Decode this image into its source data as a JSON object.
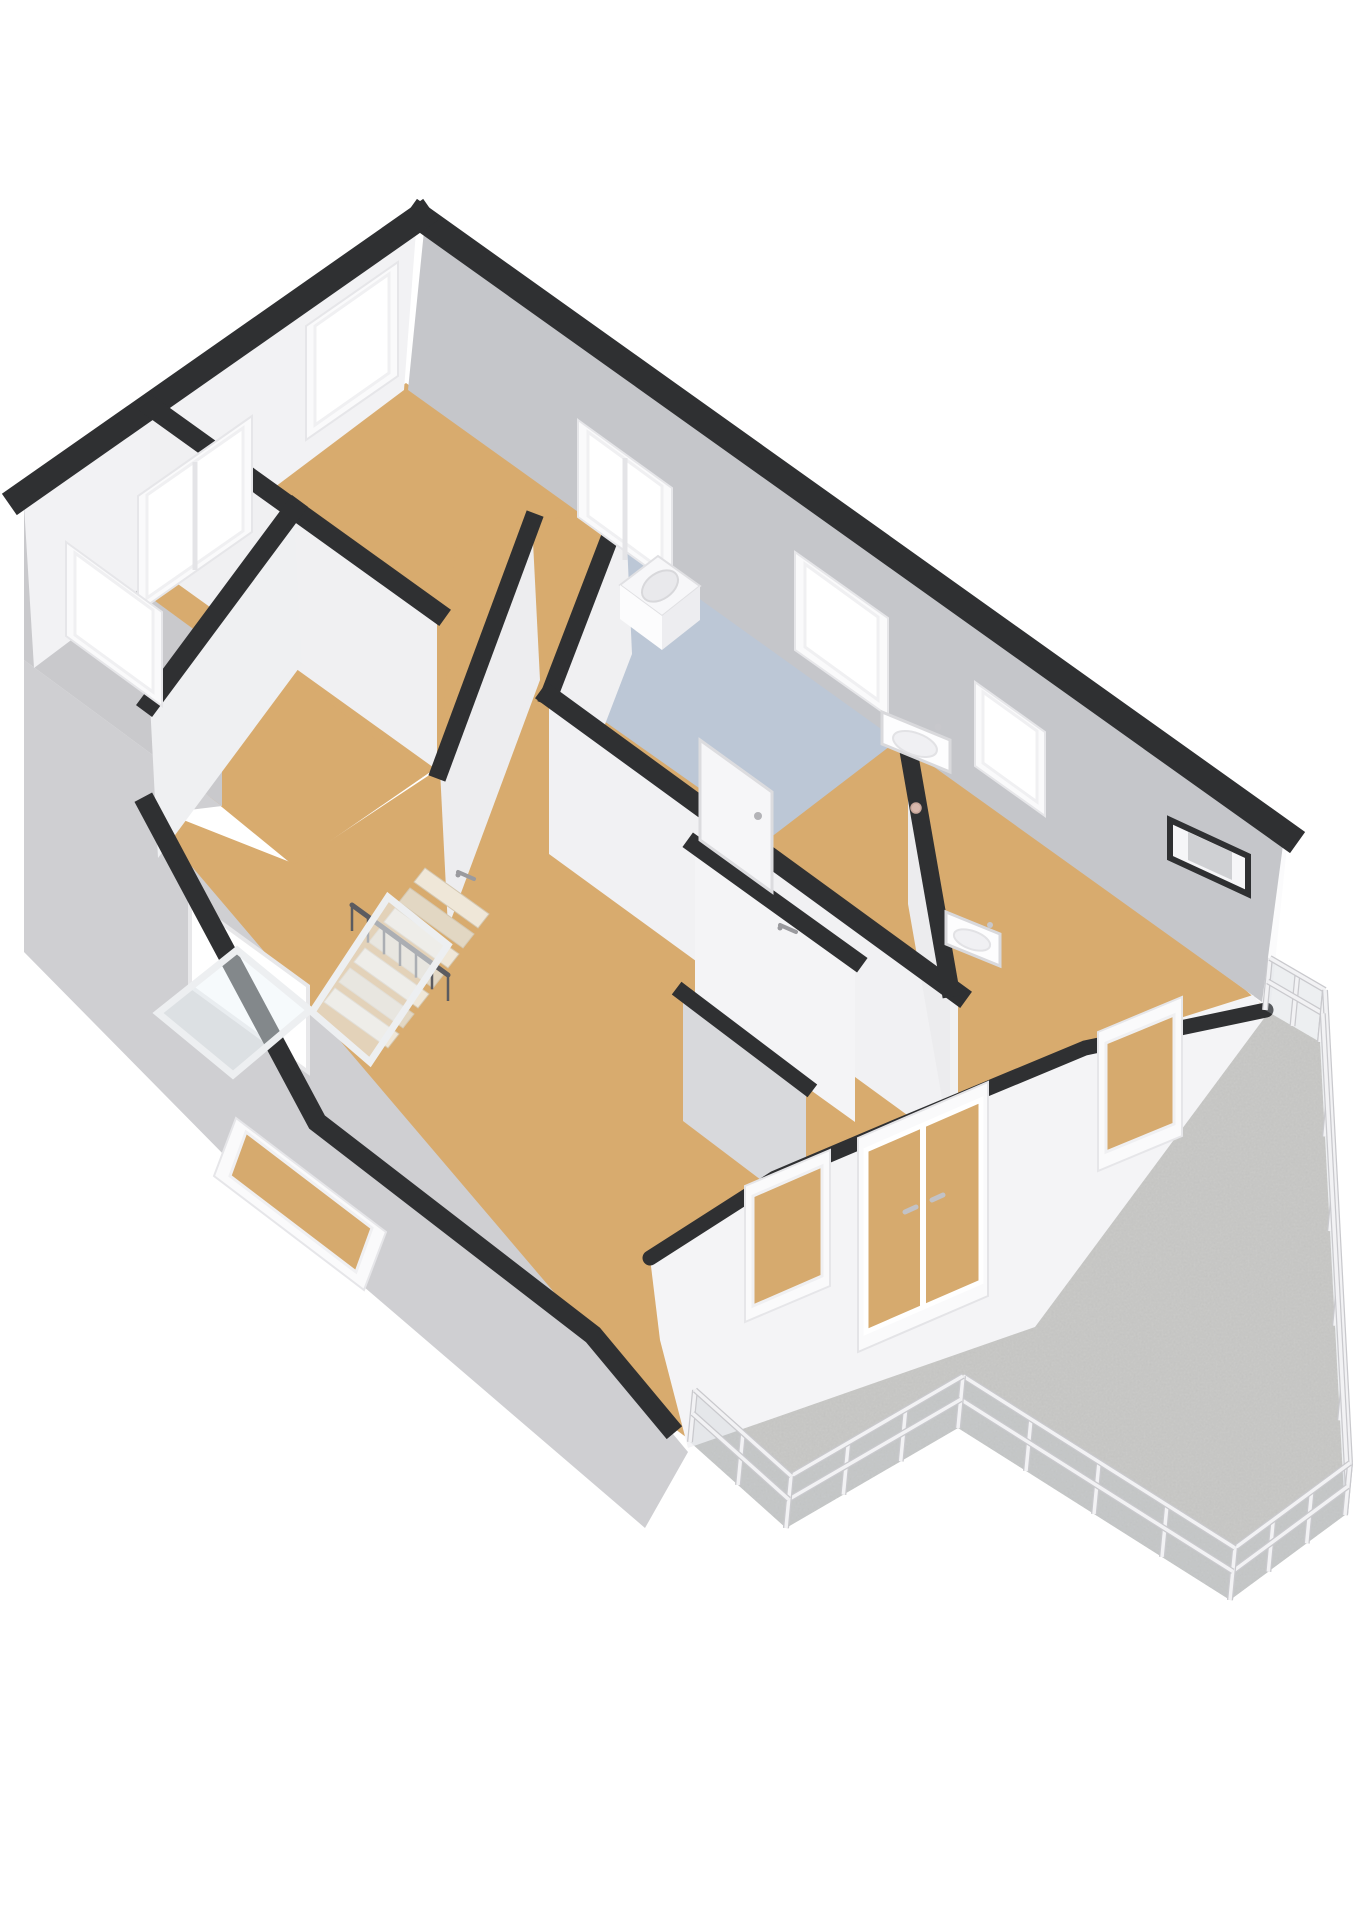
{
  "scene": {
    "type": "3d-floorplan-render",
    "view": "axonometric-top-down",
    "floor_label": "upper-floor",
    "background": "#ffffff"
  },
  "colors": {
    "band": "#2f3032",
    "wall_white": "#f2f2f4",
    "wall_gray": "#c5c6ca",
    "gable_gray": "#c9c9cc",
    "slope_gray": "#cfcfd2",
    "floor_tan": "#d8ab6e",
    "floor_blue": "#bcc7d6",
    "terrace_concrete": "#c9c9c7",
    "frame_white": "#fafafb",
    "glass_white": "#ffffff",
    "glass_tan": "#d6aa6e",
    "railing_light": "#f2f2f4",
    "railing_shadow": "#c9c9cd",
    "stair_wood_a": "#efe7d8",
    "stair_wood_b": "#e2d7c3",
    "handrail_dark": "#5b5b60"
  },
  "rooms": [
    {
      "id": "bedroom-north",
      "floor": "tan"
    },
    {
      "id": "bedroom-west",
      "floor": "tan"
    },
    {
      "id": "bathroom",
      "floor": "blue",
      "fixtures": [
        "washing-machine",
        "washbasin",
        "floor-drain"
      ]
    },
    {
      "id": "landing-hall",
      "floor": "tan",
      "fixtures": [
        "staircase",
        "glass-balustrade"
      ]
    },
    {
      "id": "bedroom-southeast",
      "floor": "tan",
      "fixtures": [
        "washbasin"
      ]
    },
    {
      "id": "room-southwest",
      "floor": "tan"
    },
    {
      "id": "terrace",
      "floor": "concrete",
      "fixtures": [
        "railing"
      ]
    }
  ],
  "floorplan": {
    "floors": {
      "apex": "406,383 694,589 423,777 135,571",
      "left": "150,560 423,777 294,866 30,650",
      "main": "455,548 625,498 900,740 1262,1002 690,1440 660,1418 590,1332 315,1120 148,806 295,864 440,768",
      "bath": "640,528 898,740 770,838 560,690"
    },
    "faces": {
      "ne": {
        "pts": "424,231 1283,845 1262,1002 408,390",
        "fill": "#c5c6ca"
      },
      "nw": {
        "pts": "416,231 24,505 34,668 404,390",
        "fill": "#f2f2f4"
      },
      "gable_left": {
        "pts": "24,505 222,650 222,806 24,660",
        "fill": "#c9c9cc"
      },
      "w1": {
        "pts": "150,406 437,612 437,770 150,564",
        "fill": "#f0f0f2"
      },
      "w_leftse": {
        "pts": "294,509 150,703 158,858 302,664",
        "fill": "#eff0f2"
      },
      "w2": {
        "pts": "532,522 440,770 448,928 540,680",
        "fill": "#ededef"
      },
      "w3": {
        "pts": "625,498 549,696 556,852 632,654",
        "fill": "#f0f0f2"
      },
      "w4": {
        "pts": "549,696 958,994 958,1152 549,854",
        "fill": "#f1f1f3"
      },
      "w5": {
        "pts": "695,845 855,960 855,1122 695,1007",
        "fill": "#f4f4f6"
      },
      "w6": {
        "pts": "683,993 806,1086 806,1214 683,1121",
        "fill": "#d8d9dc"
      },
      "w10": {
        "pts": "908,748 950,988 950,1144 908,904",
        "fill": "#ececee"
      },
      "right_ext": {
        "pts": "1288,836 1270,1012 1230,976 1247,858",
        "fill": "#fbfbfc"
      }
    },
    "bands": [
      {
        "pts": "420,217 1287,835",
        "w": 26
      },
      {
        "pts": "420,217 20,497",
        "w": 26
      },
      {
        "pts": "150,406 437,612",
        "w": 20
      },
      {
        "pts": "294,509 150,703",
        "w": 20
      },
      {
        "pts": "532,522 440,770",
        "w": 18
      },
      {
        "pts": "625,498 549,696",
        "w": 18
      },
      {
        "pts": "549,696 958,994",
        "w": 20
      },
      {
        "pts": "695,845 855,960",
        "w": 18
      },
      {
        "pts": "683,993 806,1086",
        "w": 16
      },
      {
        "pts": "908,748 950,988",
        "w": 18
      },
      {
        "pts": "148,806 317,1122 593,1335 668,1425",
        "w": 20
      }
    ],
    "slope": "148,815 593,1338 688,1452 645,1528 300,1232 24,952 24,660 222,806",
    "interior_sw_window": "190,900 308,986 308,1072 190,986",
    "facade_se": {
      "wall": "688,1448 1035,1327 1268,1013 1253,995 1085,1048 900,1125 775,1178 650,1258 660,1340",
      "trim": "650,1258 775,1178 900,1125 1085,1048 1266,1010",
      "trim_w": 15
    },
    "windows": {
      "ne_apex": {
        "frame": "578,420 672,488 672,585 578,517",
        "glass": "588,432 662,486 662,570 588,516",
        "fill": "#ffffff",
        "mullion": "625,458 625,560"
      },
      "ne_bath": {
        "frame": "795,552 888,618 888,716 795,650",
        "glass": "805,564 878,617 878,700 805,647",
        "fill": "#ffffff",
        "mullion": ""
      },
      "ne_right": {
        "frame": "975,682 1045,732 1045,816 975,766",
        "glass": "983,692 1037,731 1037,802 983,763",
        "fill": "#ffffff",
        "mullion": ""
      },
      "nw_apex": {
        "frame": "398,262 306,326 306,440 398,376",
        "glass": "389,274 315,326 315,425 389,373",
        "fill": "#ffffff",
        "mullion": ""
      },
      "nw_left": {
        "frame": "252,416 138,496 138,612 252,532",
        "glass": "243,428 147,495 147,598 243,531",
        "fill": "#ffffff",
        "mullion": "195,462 195,570"
      },
      "sw_gable": {
        "frame": "66,542 162,612 162,706 66,636",
        "glass": "75,553 153,610 153,692 75,635",
        "fill": "#ffffff",
        "mullion": ""
      },
      "se_win1": {
        "frame": "745,1186 830,1150 830,1286 745,1322",
        "glass": "753,1196 822,1166 822,1276 753,1306",
        "fill": "#d6aa6e",
        "mullion": ""
      },
      "se_win2": {
        "frame": "1098,1032 1182,997 1182,1136 1098,1171",
        "glass": "1106,1043 1174,1015 1174,1124 1106,1152",
        "fill": "#d6aa6e",
        "mullion": ""
      },
      "sw_long": {
        "frame": "236,1118 386,1232 364,1290 214,1176",
        "glass": "246,1132 372,1228 356,1272 230,1176",
        "fill": "#d6aa6e",
        "mullion": ""
      }
    },
    "doors_se": {
      "frame": "858,1138 988,1082 988,1296 858,1352",
      "glass": "866,1150 981,1100 981,1282 866,1332",
      "seam": "923,1125 923,1307",
      "handle_left": "905,1212 916,1207",
      "handle_right": "932,1200 943,1195"
    },
    "niche": {
      "outer": "1170,820 1248,856 1248,894 1170,858",
      "inner": "1188,832 1232,852 1232,880 1188,860"
    },
    "door_bath": {
      "panel": "700,740 772,792 772,892 700,840",
      "handle_x": 758,
      "handle_y": 816
    },
    "handles": [
      {
        "x1": 458,
        "y1": 872,
        "x2": 474,
        "y2": 879
      },
      {
        "x1": 780,
        "y1": 925,
        "x2": 796,
        "y2": 932
      }
    ]
  },
  "fixtures": {
    "washer": {
      "top": "620,585 658,556 700,586 662,616",
      "front_l": "620,585 662,616 662,650 620,619",
      "front_r": "662,616 700,586 700,620 662,650",
      "drum": {
        "cx": 660,
        "cy": 586,
        "rx": 20,
        "ry": 13,
        "rot": -35
      }
    },
    "sink_bath": {
      "body": "882,712 950,740 950,772 882,744",
      "bowl": {
        "cx": 915,
        "cy": 744,
        "rx": 23,
        "ry": 11,
        "rot": 20
      },
      "faucet": {
        "cx": 938,
        "cy": 727
      }
    },
    "sink_right": {
      "body": "946,912 1000,934 1000,966 946,944",
      "bowl": {
        "cx": 972,
        "cy": 940,
        "rx": 19,
        "ry": 9,
        "rot": 20
      },
      "faucet": {
        "cx": 990,
        "cy": 925
      }
    },
    "drain": {
      "cx": 916,
      "cy": 808,
      "r": 5
    }
  },
  "stairs": {
    "treads": {
      "n": 7,
      "x0": 425,
      "y0": 868,
      "sx": -15,
      "sy": 20,
      "wx": 64,
      "wy": 46,
      "dx": -11,
      "dy": 14
    },
    "handrail": {
      "x1": 352,
      "y1": 905,
      "x2": 448,
      "y2": 975,
      "spindles": 6,
      "drop": 26
    },
    "glass1": "312,1012 388,897 448,945 370,1062",
    "glass2": "158,1013 237,950 310,1010 233,1075"
  },
  "terrace": {
    "floor": "690,1442 1265,1010 1320,1042 1345,1515 1230,1600 958,1428 786,1528",
    "post_vx": 5,
    "post_vy": -52,
    "edges": [
      {
        "x1": 1265,
        "y1": 1010,
        "x2": 1320,
        "y2": 1042,
        "posts": 2
      },
      {
        "x1": 1320,
        "y1": 1042,
        "x2": 1345,
        "y2": 1515,
        "posts": 5
      },
      {
        "x1": 1345,
        "y1": 1515,
        "x2": 1230,
        "y2": 1600,
        "posts": 3
      },
      {
        "x1": 1230,
        "y1": 1600,
        "x2": 958,
        "y2": 1428,
        "posts": 4
      },
      {
        "x1": 958,
        "y1": 1428,
        "x2": 786,
        "y2": 1528,
        "posts": 3
      },
      {
        "x1": 786,
        "y1": 1528,
        "x2": 690,
        "y2": 1442,
        "posts": 2
      }
    ]
  }
}
